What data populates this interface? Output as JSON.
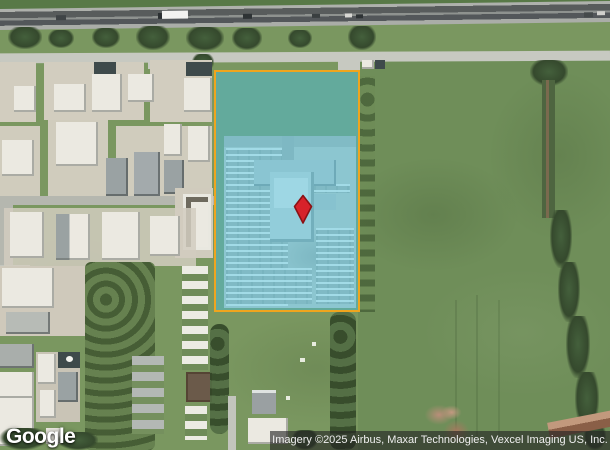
{
  "map": {
    "view_type": "satellite-imagery"
  },
  "branding": {
    "logo": "Google"
  },
  "attribution": {
    "text": "Imagery ©2025 Airbus, Maxar Technologies, Vexcel Imaging US, Inc."
  },
  "marker": {
    "icon": "location-marker-icon"
  },
  "colors": {
    "parcel-border": "#efa51e",
    "parcel-fill": "rgba(70,185,215,0.48)",
    "marker-fill": "#d7222a",
    "marker-stroke": "#8a1215",
    "attribution-bg": "rgba(35,35,35,0.62)"
  }
}
